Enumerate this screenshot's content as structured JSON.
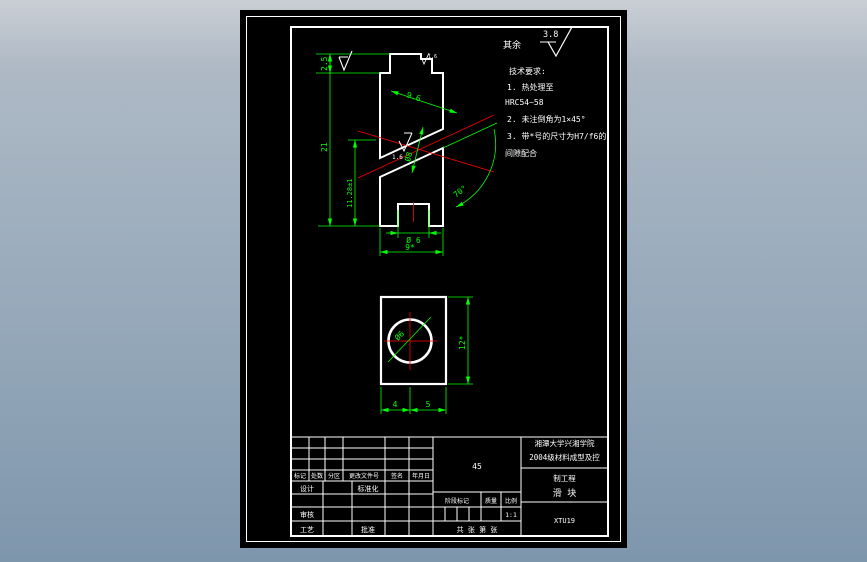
{
  "colors": {
    "dimension": "#00ff00",
    "centerline": "#ff0000",
    "line": "#ffffff",
    "canvas_bg": "#000000"
  },
  "surface_note": {
    "label": "其余",
    "value": "3.8"
  },
  "tech": {
    "title": "技术要求:",
    "line1": "1. 热处理至",
    "line2": "HRC54~58",
    "line3": "2. 未注倒角为1×45°",
    "line4": "3. 带*号的尺寸为H7/f6的",
    "line5": "间隙配合"
  },
  "front_view": {
    "dims": {
      "step_height": "2.5",
      "total_height": "21",
      "slot_position": "11.28±1",
      "slot_length": "9.6",
      "hole_dia": "Ø8",
      "slot_roughness": "1.6",
      "top_roughness": "1.6",
      "angle": "70°",
      "notch_dia": "Ø 6",
      "width": "9*"
    }
  },
  "bottom_view": {
    "dims": {
      "hole_dia": "Ø6",
      "height": "12*",
      "left_width": "4",
      "right_width": "5"
    }
  },
  "title_block": {
    "school_line1": "湘潭大学兴湘学院",
    "school_line2": "2004级材料成型及控",
    "school_line3": "制工程",
    "part_name": "滑 块",
    "drawing_no": "XTU19",
    "material": "45",
    "scale": "1:1",
    "labels": {
      "mark": "标记",
      "count": "处数",
      "zone": "分区",
      "doc_no": "更改文件号",
      "sign": "签名",
      "date": "年月日",
      "design": "设计",
      "standardize": "标准化",
      "check": "审核",
      "process": "工艺",
      "approve": "批准",
      "stage": "阶段标记",
      "weight": "质量",
      "scale_label": "比例",
      "sheets": "共 张 第 张"
    }
  }
}
